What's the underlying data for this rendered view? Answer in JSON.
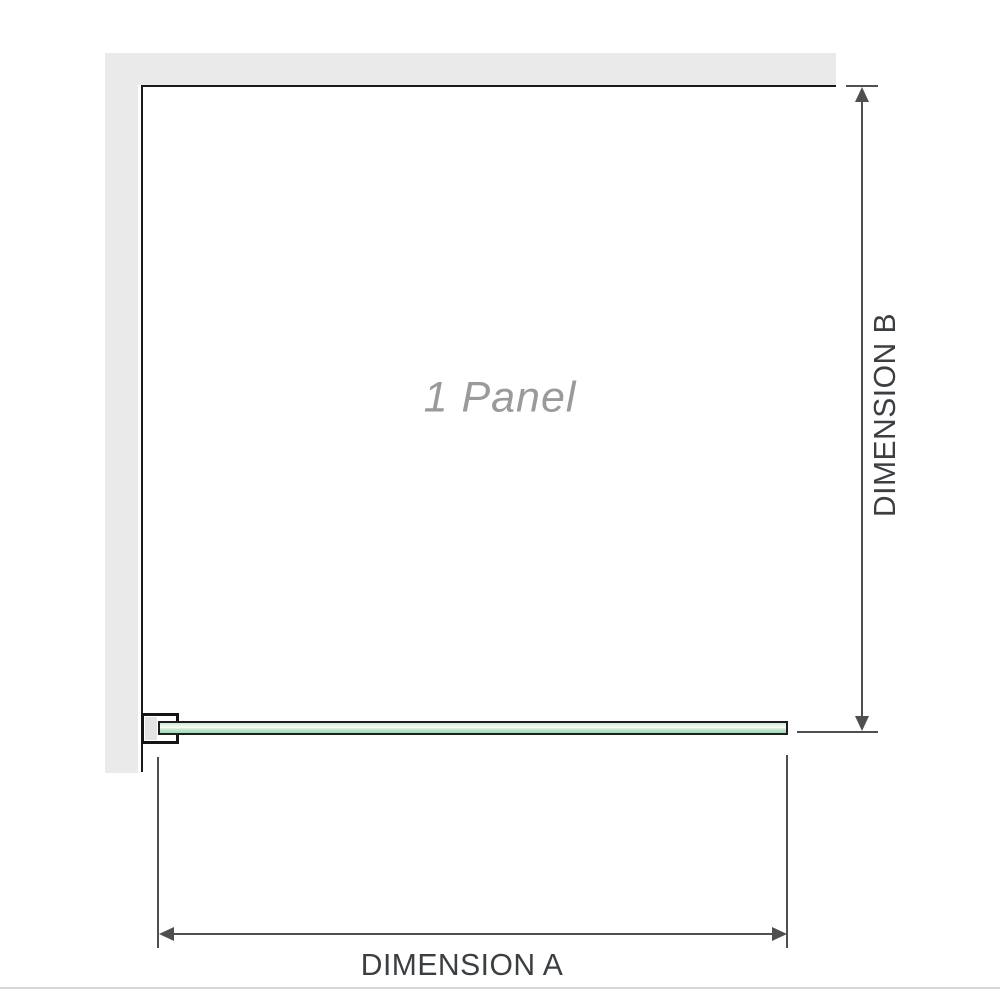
{
  "labels": {
    "panel": "1 Panel",
    "dimension_a": "DIMENSION A",
    "dimension_b": "DIMENSION B"
  },
  "colors": {
    "wall": "#eaeaea",
    "outline": "#1a1a1a",
    "glass_green": "#a6d8b2",
    "glass_highlight": "#ffffff",
    "glass_border": "#1e1e1e",
    "dimension_line": "#4f4f4f",
    "dimension_text": "#3b3f42",
    "panel_text": "#9a9a9a",
    "divider": "#d9d9d4"
  }
}
